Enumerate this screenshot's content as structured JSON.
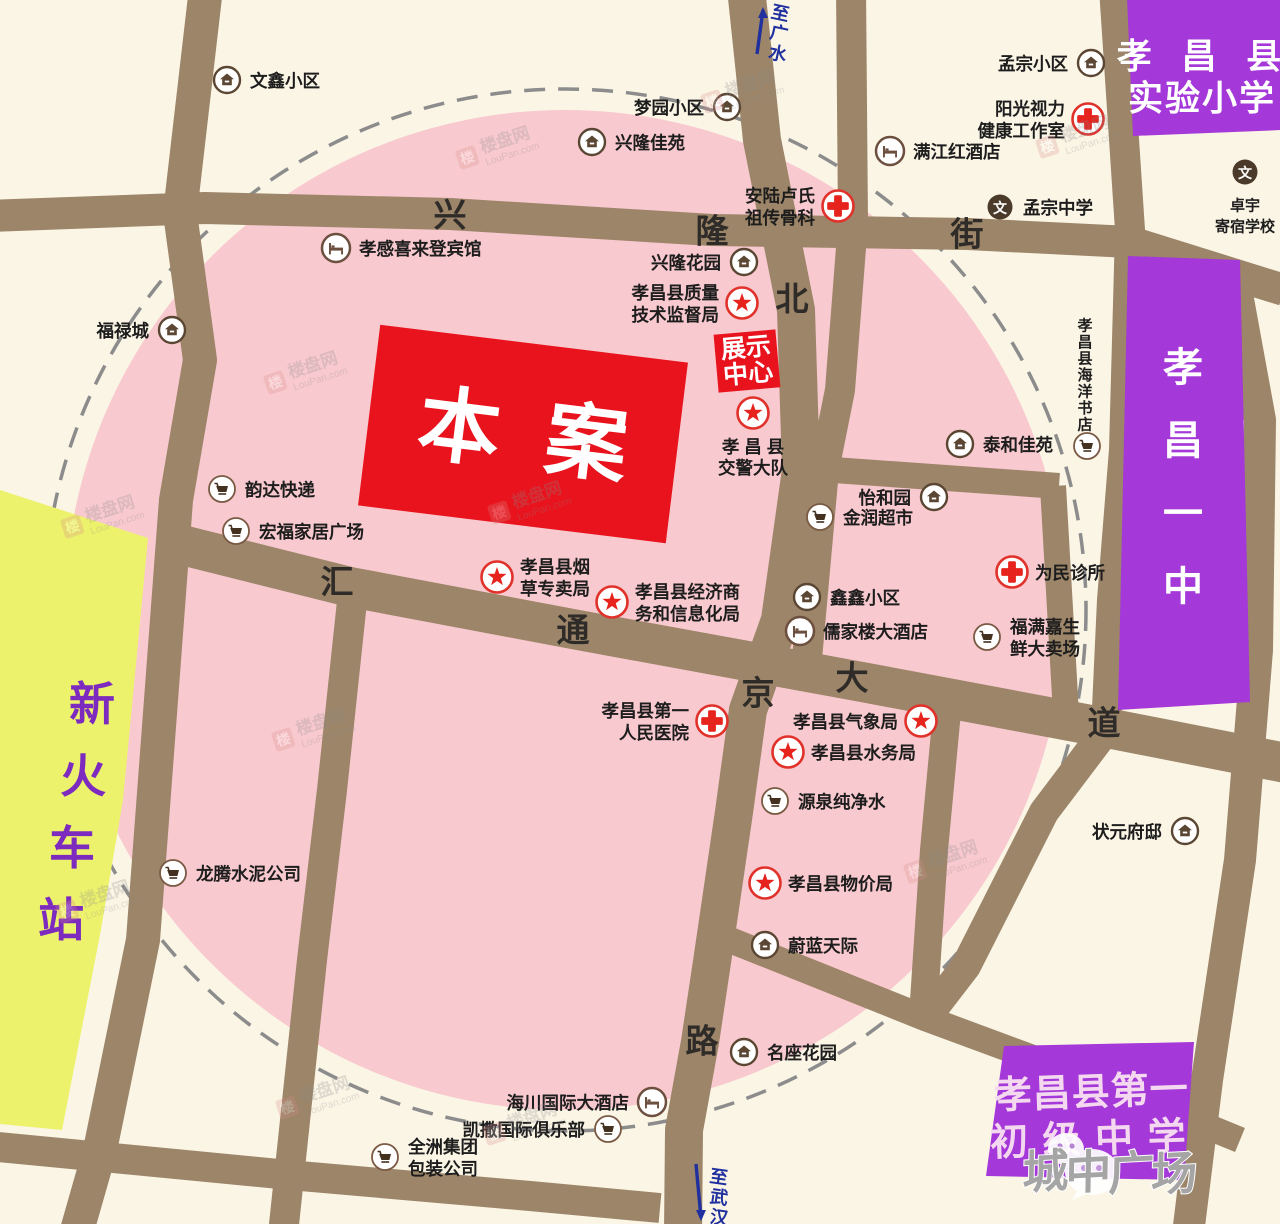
{
  "canvas": {
    "w": 1280,
    "h": 1224
  },
  "colors": {
    "background": "#fbf5e6",
    "pink_zone": "#f8c9ce",
    "dashed_ring": "#8c8c8c",
    "road": "#9c8568",
    "road_text": "#2e2b28",
    "label_text": "#1d1d1d",
    "purple_zone": "#a438d8",
    "purple_zone_text": "#ffffff",
    "jr_high_text": "#f4d8f0",
    "yellow_zone": "#edf26d",
    "station_text": "#7c2bbe",
    "project_red": "#e8131d",
    "project_text": "#ffffff",
    "star_red": "#e6231d",
    "cross_red": "#e0312b",
    "icon_brown": "#5a4632",
    "hotel_brown": "#6d4f3f",
    "cart_brown": "#7a5a44",
    "school_circle": "#4b3a29",
    "direction_blue": "#20309e",
    "watermark_gray": "#8a8a8a",
    "brand_gray": "#a5a5a5"
  },
  "zones": {
    "pink_circle": {
      "cx": 565,
      "cy": 610,
      "r": 500
    },
    "dashed_circle": {
      "cx": 565,
      "cy": 610,
      "r": 521
    },
    "station": {
      "label": "新火车站",
      "points": [
        [
          0,
          490
        ],
        [
          148,
          538
        ],
        [
          123,
          800
        ],
        [
          100,
          935
        ],
        [
          62,
          1130
        ],
        [
          0,
          1124
        ]
      ],
      "chars": [
        {
          "c": "新",
          "x": 92,
          "y": 704
        },
        {
          "c": "火",
          "x": 83,
          "y": 776
        },
        {
          "c": "车",
          "x": 72,
          "y": 848
        },
        {
          "c": "站",
          "x": 61,
          "y": 920
        }
      ]
    },
    "primary_school": {
      "name": "孝昌县实验小学",
      "points": [
        [
          1127,
          -2
        ],
        [
          1282,
          -2
        ],
        [
          1282,
          130
        ],
        [
          1133,
          136
        ]
      ],
      "lines": [
        {
          "t": "孝 昌 县",
          "x": 1204,
          "y": 57,
          "ls": 10
        },
        {
          "t": "实验小学",
          "x": 1202,
          "y": 99,
          "ls": 2
        }
      ]
    },
    "cutout": {
      "points": [
        [
          1186,
          136
        ],
        [
          1282,
          130
        ],
        [
          1282,
          240
        ],
        [
          1198,
          246
        ]
      ]
    },
    "no1_middle": {
      "name": "孝昌一中",
      "points": [
        [
          1128,
          256
        ],
        [
          1240,
          260
        ],
        [
          1250,
          702
        ],
        [
          1118,
          710
        ]
      ],
      "chars": [
        {
          "c": "孝",
          "x": 1183,
          "y": 368
        },
        {
          "c": "昌",
          "x": 1183,
          "y": 441
        },
        {
          "c": "一",
          "x": 1183,
          "y": 514
        },
        {
          "c": "中",
          "x": 1183,
          "y": 587
        }
      ]
    },
    "junior_high": {
      "name": "孝昌县第一初级中学",
      "points": [
        [
          1004,
          1046
        ],
        [
          1194,
          1042
        ],
        [
          1184,
          1180
        ],
        [
          986,
          1176
        ]
      ],
      "rot": -2,
      "lines": [
        {
          "t": "孝昌县第一",
          "x": 1092,
          "y": 1093,
          "ls": 1
        },
        {
          "t": "初 级 中 学",
          "x": 1088,
          "y": 1140,
          "ls": 2
        }
      ]
    }
  },
  "project": {
    "label_chars": [
      "本",
      "案"
    ],
    "cx": 523,
    "cy": 434,
    "w": 310,
    "h": 182,
    "rot": 7
  },
  "display_center": {
    "lines": [
      "展示",
      "中心"
    ],
    "cx": 747,
    "cy": 361,
    "w": 62,
    "h": 58,
    "rot": -5
  },
  "roads": {
    "segments": [
      {
        "id": "west-vertical",
        "w": 34,
        "pts": [
          [
            206,
            -12
          ],
          [
            180,
            213
          ],
          [
            200,
            360
          ],
          [
            176,
            500
          ],
          [
            143,
            940
          ],
          [
            100,
            1150
          ],
          [
            76,
            1234
          ]
        ]
      },
      {
        "id": "beijing-road",
        "w": 38,
        "pts": [
          [
            746,
            -12
          ],
          [
            762,
            140
          ],
          [
            796,
            310
          ],
          [
            801,
            470
          ],
          [
            780,
            620
          ],
          [
            748,
            710
          ],
          [
            734,
            812
          ],
          [
            712,
            962
          ],
          [
            700,
            1042
          ],
          [
            684,
            1130
          ],
          [
            683,
            1234
          ]
        ]
      },
      {
        "id": "southwest-vertical",
        "w": 30,
        "pts": [
          [
            353,
            592
          ],
          [
            332,
            790
          ],
          [
            312,
            960
          ],
          [
            283,
            1234
          ]
        ]
      },
      {
        "id": "north-vertical",
        "w": 30,
        "pts": [
          [
            851,
            -12
          ],
          [
            853,
            222
          ],
          [
            840,
            390
          ],
          [
            824,
            470
          ],
          [
            806,
            670
          ]
        ]
      },
      {
        "id": "east-edge",
        "w": 32,
        "pts": [
          [
            1233,
            272
          ],
          [
            1260,
            420
          ],
          [
            1257,
            650
          ],
          [
            1240,
            860
          ],
          [
            1207,
            1080
          ],
          [
            1188,
            1234
          ]
        ]
      },
      {
        "id": "mid-east-vertical",
        "w": 28,
        "pts": [
          [
            949,
            690
          ],
          [
            934,
            850
          ],
          [
            923,
            1016
          ]
        ]
      },
      {
        "id": "yizhong-west",
        "w": 30,
        "pts": [
          [
            1114,
            -12
          ],
          [
            1130,
            230
          ],
          [
            1124,
            450
          ],
          [
            1112,
            600
          ],
          [
            1106,
            730
          ],
          [
            1044,
            812
          ],
          [
            966,
            966
          ],
          [
            926,
            1018
          ]
        ]
      },
      {
        "id": "xinglong-street",
        "w": 32,
        "pts": [
          [
            -12,
            216
          ],
          [
            205,
            208
          ],
          [
            450,
            214
          ],
          [
            712,
            230
          ],
          [
            968,
            234
          ],
          [
            1130,
            242
          ],
          [
            1284,
            290
          ]
        ]
      },
      {
        "id": "huitong-avenue",
        "w": 40,
        "pts": [
          [
            182,
            545
          ],
          [
            350,
            587
          ],
          [
            578,
            630
          ],
          [
            862,
            682
          ],
          [
            1107,
            728
          ],
          [
            1286,
            763
          ]
        ]
      },
      {
        "id": "south-horizontal",
        "w": 30,
        "pts": [
          [
            -12,
            1146
          ],
          [
            300,
            1176
          ],
          [
            530,
            1196
          ],
          [
            660,
            1208
          ]
        ]
      },
      {
        "id": "southeast-diagonal",
        "w": 26,
        "pts": [
          [
            730,
            940
          ],
          [
            925,
            1018
          ],
          [
            1060,
            1068
          ],
          [
            1196,
            1122
          ],
          [
            1240,
            1140
          ]
        ]
      },
      {
        "id": "jinrun-road",
        "w": 26,
        "pts": [
          [
            791,
            467
          ],
          [
            1059,
            486
          ]
        ]
      },
      {
        "id": "jinrun-south",
        "w": 26,
        "pts": [
          [
            1053,
            486
          ],
          [
            1066,
            714
          ]
        ]
      }
    ],
    "names": [
      {
        "name": "兴隆街",
        "chars": [
          {
            "c": "兴",
            "x": 450,
            "y": 215
          },
          {
            "c": "隆",
            "x": 712,
            "y": 231
          },
          {
            "c": "街",
            "x": 967,
            "y": 234
          }
        ]
      },
      {
        "name": "北京路",
        "chars": [
          {
            "c": "北",
            "x": 792,
            "y": 299
          },
          {
            "c": "京",
            "x": 758,
            "y": 693
          },
          {
            "c": "路",
            "x": 702,
            "y": 1041
          }
        ]
      },
      {
        "name": "汇通大道",
        "chars": [
          {
            "c": "汇",
            "x": 337,
            "y": 582
          },
          {
            "c": "通",
            "x": 573,
            "y": 630
          },
          {
            "c": "大",
            "x": 852,
            "y": 678
          },
          {
            "c": "道",
            "x": 1104,
            "y": 723
          }
        ]
      }
    ]
  },
  "directions": [
    {
      "name": "to-guangshui",
      "chars": [
        "至",
        "广",
        "水"
      ],
      "cx": 776,
      "cy": 33,
      "rot": 12,
      "arrow": {
        "x1": 757,
        "y1": 54,
        "x2": 763,
        "y2": 10,
        "head": "up"
      }
    },
    {
      "name": "to-wuhan",
      "chars": [
        "至",
        "武",
        "汉"
      ],
      "cx": 716,
      "cy": 1197,
      "rot": 8,
      "arrow": {
        "x1": 696,
        "y1": 1164,
        "x2": 701,
        "y2": 1218,
        "head": "down"
      }
    }
  ],
  "pois": [
    {
      "t": "house",
      "x": 227,
      "y": 80,
      "s": "right",
      "l": [
        "文鑫小区"
      ]
    },
    {
      "t": "house",
      "x": 592,
      "y": 142,
      "s": "right",
      "l": [
        "兴隆佳苑"
      ]
    },
    {
      "t": "house",
      "x": 727,
      "y": 107,
      "s": "left",
      "l": [
        "梦园小区"
      ]
    },
    {
      "t": "house",
      "x": 1091,
      "y": 63,
      "s": "left",
      "l": [
        "孟宗小区"
      ]
    },
    {
      "t": "cross",
      "x": 1088,
      "y": 119,
      "s": "left",
      "l": [
        "阳光视力",
        "健康工作室"
      ]
    },
    {
      "t": "hotel",
      "x": 890,
      "y": 151,
      "s": "right",
      "l": [
        "满江红酒店"
      ]
    },
    {
      "t": "cross",
      "x": 838,
      "y": 206,
      "s": "left",
      "l": [
        "安陆卢氏",
        "祖传骨科"
      ]
    },
    {
      "t": "school",
      "x": 1000,
      "y": 207,
      "s": "right",
      "l": [
        "孟宗中学"
      ]
    },
    {
      "t": "school",
      "x": 1245,
      "y": 172,
      "s": "below",
      "l": [
        "卓宇",
        "寄宿学校"
      ],
      "fs": 15
    },
    {
      "t": "hotel",
      "x": 336,
      "y": 248,
      "s": "right",
      "l": [
        "孝感喜来登宾馆"
      ]
    },
    {
      "t": "house",
      "x": 744,
      "y": 262,
      "s": "left",
      "l": [
        "兴隆花园"
      ]
    },
    {
      "t": "star",
      "x": 742,
      "y": 303,
      "s": "left",
      "l": [
        "孝昌县质量",
        "技术监督局"
      ]
    },
    {
      "t": "house",
      "x": 172,
      "y": 330,
      "s": "left",
      "l": [
        "福禄城"
      ]
    },
    {
      "t": "star",
      "x": 753,
      "y": 413,
      "s": "below",
      "l": [
        "孝 昌 县",
        "交警大队"
      ]
    },
    {
      "t": "house",
      "x": 960,
      "y": 444,
      "s": "right",
      "l": [
        "泰和佳苑"
      ]
    },
    {
      "t": "cart",
      "x": 222,
      "y": 489,
      "s": "right",
      "l": [
        "韵达快递"
      ]
    },
    {
      "t": "house",
      "x": 934,
      "y": 497,
      "s": "left",
      "l": [
        "怡和园"
      ]
    },
    {
      "t": "cart",
      "x": 820,
      "y": 517,
      "s": "right",
      "l": [
        "金润超市"
      ]
    },
    {
      "t": "cart",
      "x": 236,
      "y": 531,
      "s": "right",
      "l": [
        "宏福家居广场"
      ]
    },
    {
      "t": "cross",
      "x": 1012,
      "y": 572,
      "s": "right",
      "l": [
        "为民诊所"
      ]
    },
    {
      "t": "star",
      "x": 497,
      "y": 577,
      "s": "right",
      "l": [
        "孝昌县烟",
        "草专卖局"
      ]
    },
    {
      "t": "house",
      "x": 807,
      "y": 597,
      "s": "right",
      "l": [
        "鑫鑫小区"
      ]
    },
    {
      "t": "star",
      "x": 612,
      "y": 602,
      "s": "right",
      "l": [
        "孝昌县经济商",
        "务和信息化局"
      ]
    },
    {
      "t": "hotel",
      "x": 800,
      "y": 631,
      "s": "right",
      "l": [
        "儒家楼大酒店"
      ]
    },
    {
      "t": "cart",
      "x": 987,
      "y": 637,
      "s": "right",
      "l": [
        "福满嘉生",
        "鲜大卖场"
      ]
    },
    {
      "t": "cart",
      "x": 1087,
      "y": 446,
      "s": "vert",
      "l": [
        "孝昌县海洋书店"
      ],
      "fs": 15
    },
    {
      "t": "cross",
      "x": 712,
      "y": 721,
      "s": "left",
      "l": [
        "孝昌县第一",
        "人民医院"
      ]
    },
    {
      "t": "star",
      "x": 921,
      "y": 721,
      "s": "left",
      "l": [
        "孝昌县气象局"
      ]
    },
    {
      "t": "star",
      "x": 788,
      "y": 752,
      "s": "right",
      "l": [
        "孝昌县水务局"
      ]
    },
    {
      "t": "cart",
      "x": 775,
      "y": 801,
      "s": "right",
      "l": [
        "源泉纯净水"
      ]
    },
    {
      "t": "house",
      "x": 1185,
      "y": 831,
      "s": "left",
      "l": [
        "状元府邸"
      ]
    },
    {
      "t": "cart",
      "x": 173,
      "y": 873,
      "s": "right",
      "l": [
        "龙腾水泥公司"
      ]
    },
    {
      "t": "star",
      "x": 765,
      "y": 883,
      "s": "right",
      "l": [
        "孝昌县物价局"
      ]
    },
    {
      "t": "house",
      "x": 765,
      "y": 945,
      "s": "right",
      "l": [
        "蔚蓝天际"
      ]
    },
    {
      "t": "house",
      "x": 744,
      "y": 1052,
      "s": "right",
      "l": [
        "名座花园"
      ]
    },
    {
      "t": "hotel",
      "x": 652,
      "y": 1102,
      "s": "left",
      "l": [
        "海川国际大酒店"
      ]
    },
    {
      "t": "cart",
      "x": 608,
      "y": 1129,
      "s": "left",
      "l": [
        "凯撒国际俱乐部"
      ]
    },
    {
      "t": "cart",
      "x": 385,
      "y": 1157,
      "s": "right",
      "l": [
        "全洲集团",
        "包装公司"
      ]
    }
  ],
  "watermark": {
    "logo_char": "楼",
    "text": "楼盘网",
    "sub": "LouPan.com",
    "positions": [
      [
        500,
        148
      ],
      [
        745,
        92
      ],
      [
        1080,
        137
      ],
      [
        308,
        373
      ],
      [
        105,
        517
      ],
      [
        532,
        503
      ],
      [
        316,
        730
      ],
      [
        100,
        902
      ],
      [
        948,
        862
      ],
      [
        320,
        1098
      ],
      [
        527,
        1124
      ]
    ]
  },
  "corner_brand": {
    "text_chars": [
      {
        "c": "城",
        "x": 1127,
        "y": 1164
      },
      {
        "c": "中",
        "x": 1170,
        "y": 1167
      },
      {
        "c": "广",
        "x": 1213,
        "y": 1170
      },
      {
        "c": "场",
        "x": 1256,
        "y": 1173
      }
    ],
    "icon": "wechat-icon"
  }
}
